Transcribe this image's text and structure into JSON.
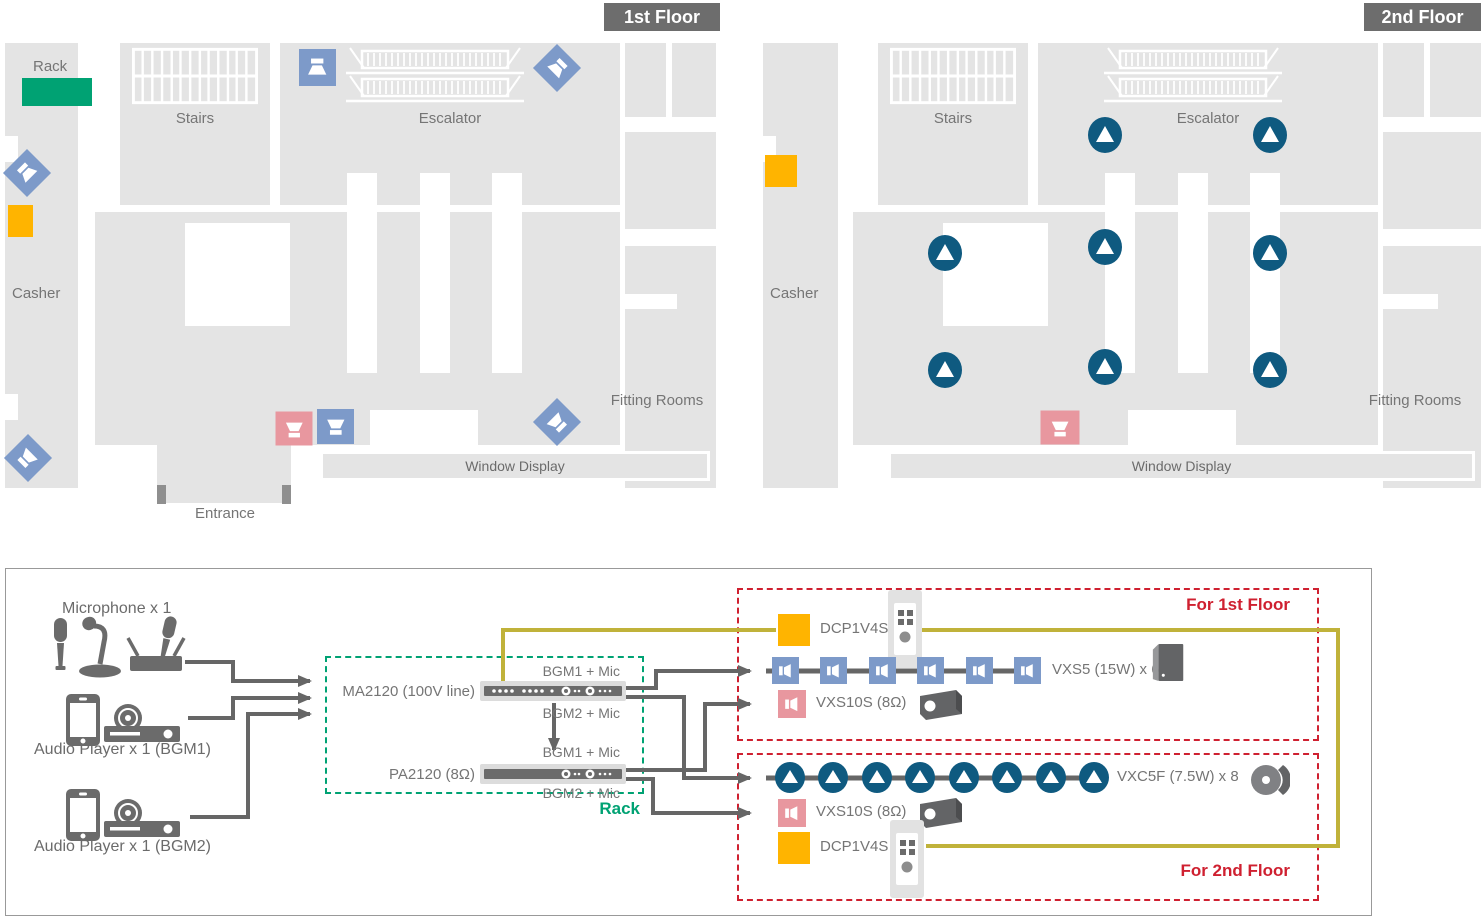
{
  "floor1": {
    "badge": "1st Floor",
    "rack_label": "Rack",
    "stairs": "Stairs",
    "escalator": "Escalator",
    "casher": "Casher",
    "fitting_rooms": "Fitting Rooms",
    "window_display": "Window Display",
    "entrance": "Entrance"
  },
  "floor2": {
    "badge": "2nd Floor",
    "stairs": "Stairs",
    "escalator": "Escalator",
    "casher": "Casher",
    "fitting_rooms": "Fitting Rooms",
    "window_display": "Window Display"
  },
  "system": {
    "sources": {
      "microphone_label": "Microphone x 1",
      "bgm1_label": "Audio Player x 1 (BGM1)",
      "bgm2_label": "Audio Player x 1 (BGM2)"
    },
    "rack": {
      "label": "Rack",
      "ma2120_label": "MA2120 (100V line)",
      "pa2120_label": "PA2120 (8Ω)",
      "ma_out1": "BGM1 + Mic",
      "ma_out2": "BGM2 + Mic",
      "pa_out1": "BGM1 + Mic",
      "pa_out2": "BGM2 + Mic"
    },
    "zone1": {
      "title": "For 1st Floor",
      "dcp_label": "DCP1V4S",
      "vxs5_label": "VXS5 (15W) x 6",
      "vxs10s_label": "VXS10S (8Ω)"
    },
    "zone2": {
      "title": "For 2nd Floor",
      "vxc5f_label": "VXC5F (7.5W) x 8",
      "vxs10s_label": "VXS10S (8Ω)",
      "dcp_label": "DCP1V4S"
    }
  },
  "colors": {
    "accent_green": "#00a273",
    "accent_red": "#cf2030",
    "accent_orange": "#ffb400",
    "speaker_blue": "#7d9ac9",
    "speaker_pink": "#e8979f",
    "speaker_teal": "#0f5a80",
    "wire_gray": "#666666",
    "wire_olive": "#c0b23a",
    "floor_gray": "#e4e4e4",
    "badge_gray": "#6d6d6d"
  }
}
